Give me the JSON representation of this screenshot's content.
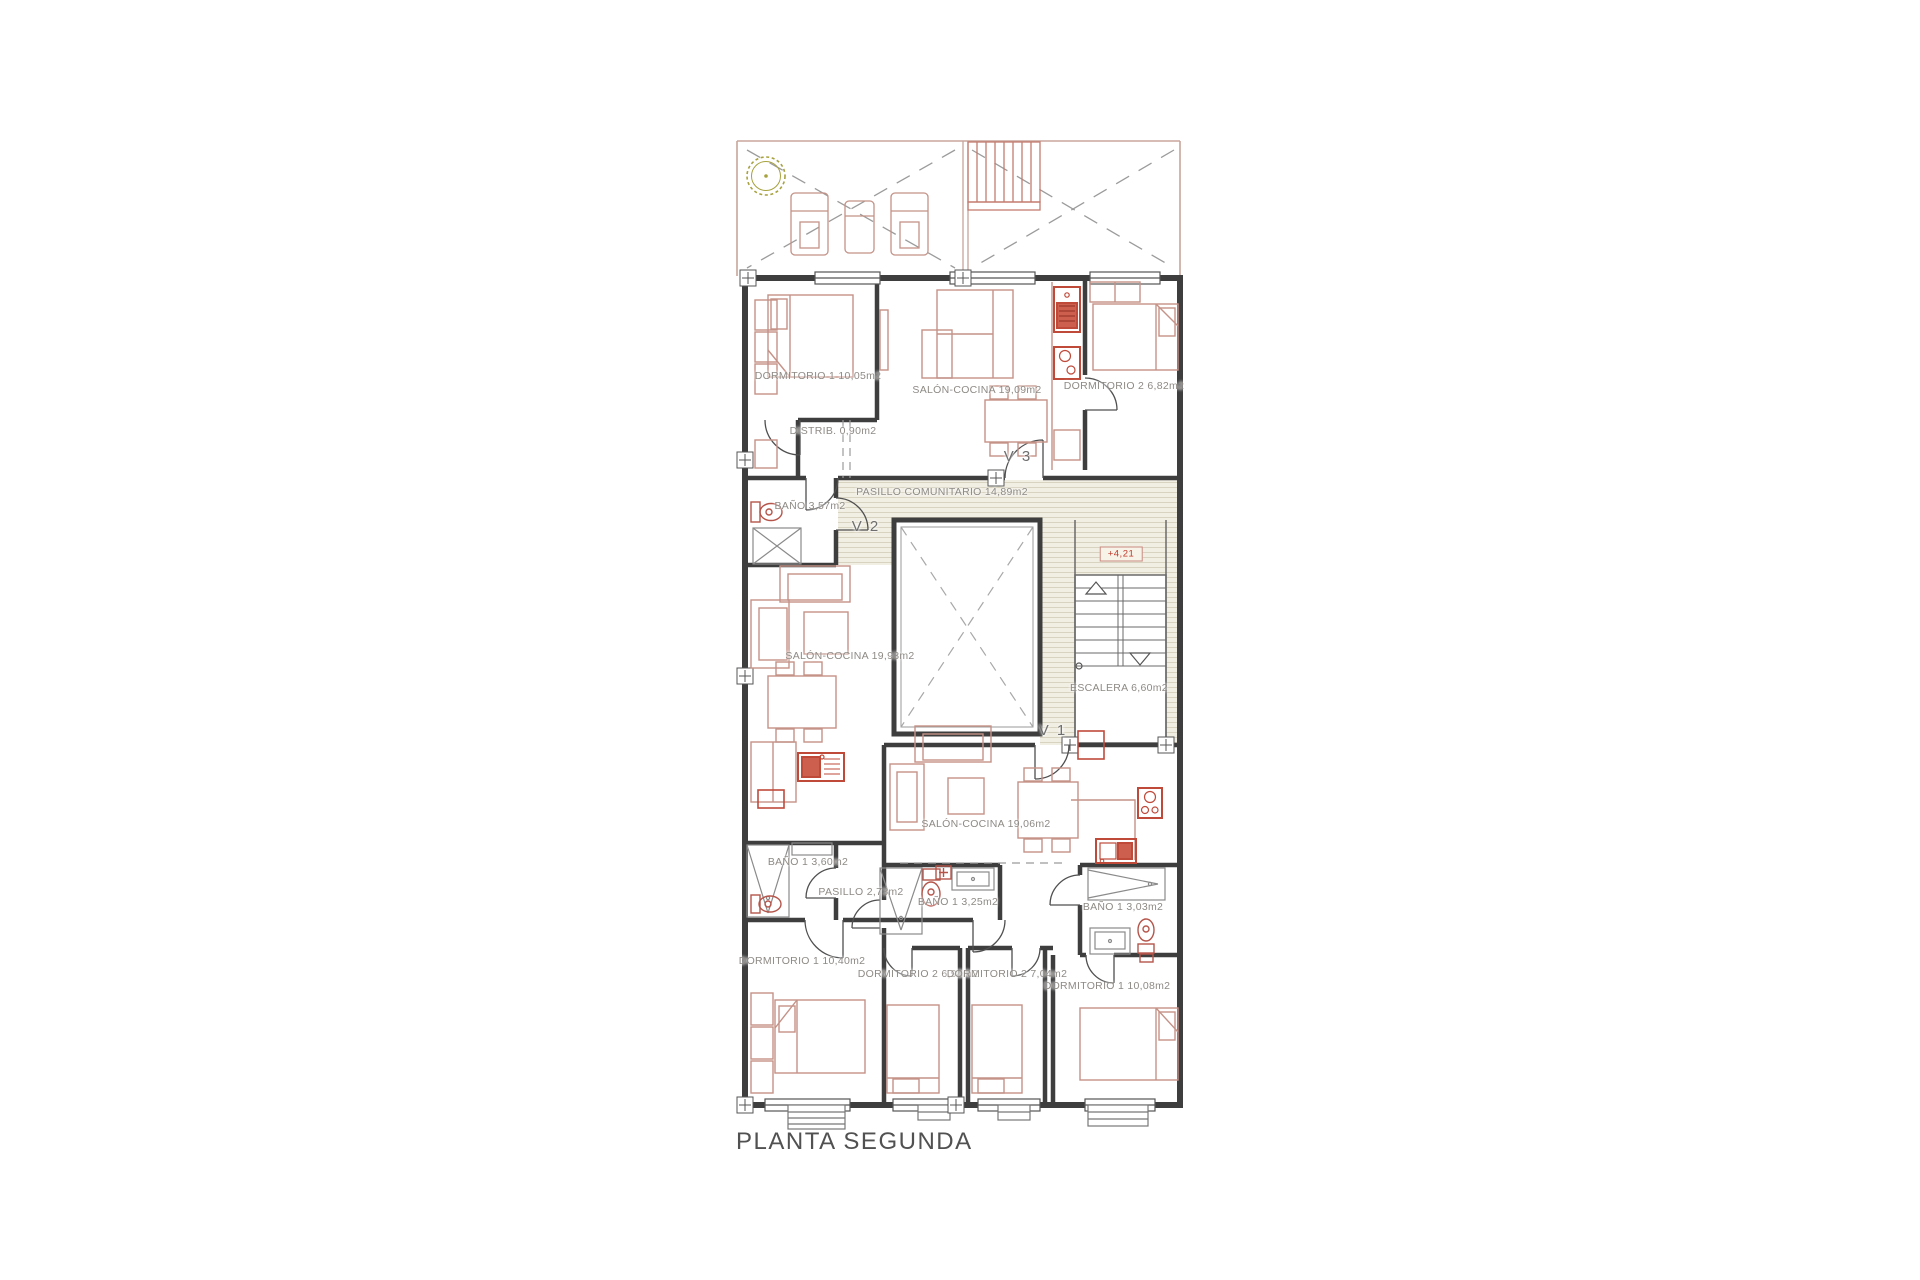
{
  "title": "PLANTA SEGUNDA",
  "level_mark": "+4,21",
  "doors": {
    "v1": "V 1",
    "v2": "V 2",
    "v3": "V 3"
  },
  "rooms": [
    {
      "name": "DORMITORIO 1",
      "area": "10,05m2"
    },
    {
      "name": "SALÓN-COCINA",
      "area": "19,09m2"
    },
    {
      "name": "DORMITORIO 2",
      "area": "6,82m2"
    },
    {
      "name": "DISTRIB.",
      "area": "0,90m2"
    },
    {
      "name": "BAÑO",
      "area": "3,57m2"
    },
    {
      "name": "PASILLO COMUNITARIO",
      "area": "14,89m2"
    },
    {
      "name": "ESCALERA",
      "area": "6,60m2"
    },
    {
      "name": "SALÓN-COCINA",
      "area": "19,93m2"
    },
    {
      "name": "SALÓN-COCINA",
      "area": "19,06m2"
    },
    {
      "name": "BAÑO 1",
      "area": "3,60m2"
    },
    {
      "name": "PASILLO",
      "area": "2,73m2"
    },
    {
      "name": "BAÑO 1",
      "area": "3,25m2"
    },
    {
      "name": "BAÑO 1",
      "area": "3,03m2"
    },
    {
      "name": "DORMITORIO 1",
      "area": "10,40m2"
    },
    {
      "name": "DORMITORIO 2",
      "area": "6,94m2"
    },
    {
      "name": "DORMITORIO 2",
      "area": "7,04m2"
    },
    {
      "name": "DORMITORIO 1",
      "area": "10,08m2"
    }
  ],
  "colors": {
    "wall": "#3e3e3e",
    "furniture": "#c49287",
    "fixture_red": "#bf4a3a",
    "hatch_bg": "#f1eee3",
    "hatch_line": "#d8d3c0",
    "terrace_line": "#c8a59b",
    "tree": "#a7a23f",
    "label_text": "#8e8a85",
    "title_text": "#515151"
  }
}
